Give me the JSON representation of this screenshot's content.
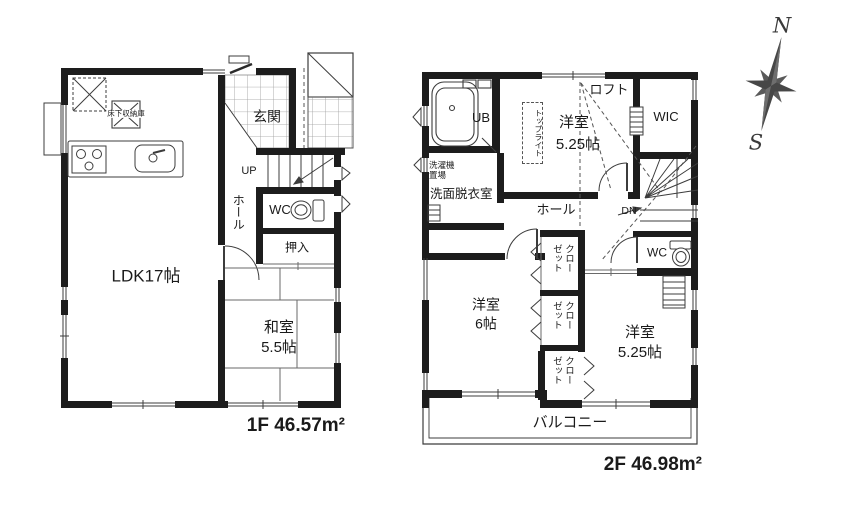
{
  "floor1": {
    "title": "1F 46.57m²",
    "labels": {
      "underfloor_storage": "床下収納庫",
      "entrance": "玄関",
      "up": "UP",
      "hall": "ホール",
      "wc": "WC",
      "closet": "押入",
      "ldk": "LDK17帖",
      "japanese_room": "和室",
      "japanese_room_size": "5.5帖"
    }
  },
  "floor2": {
    "title": "2F 46.98m²",
    "labels": {
      "unit_bath": "UB",
      "washer_line1": "洗濯機",
      "washer_line2": "置場",
      "washroom": "洗面脱衣室",
      "skylight": "トップライト",
      "bedroom": "洋室",
      "bedroom_top_size": "5.25帖",
      "loft": "ロフト",
      "wic": "WIC",
      "hall": "ホール",
      "down": "DN",
      "wc": "WC",
      "closet": "クローゼット",
      "bedroom_left_size": "6帖",
      "bedroom_right_size": "5.25帖",
      "balcony": "バルコニー"
    }
  },
  "compass": {
    "north": "N",
    "south": "S"
  }
}
